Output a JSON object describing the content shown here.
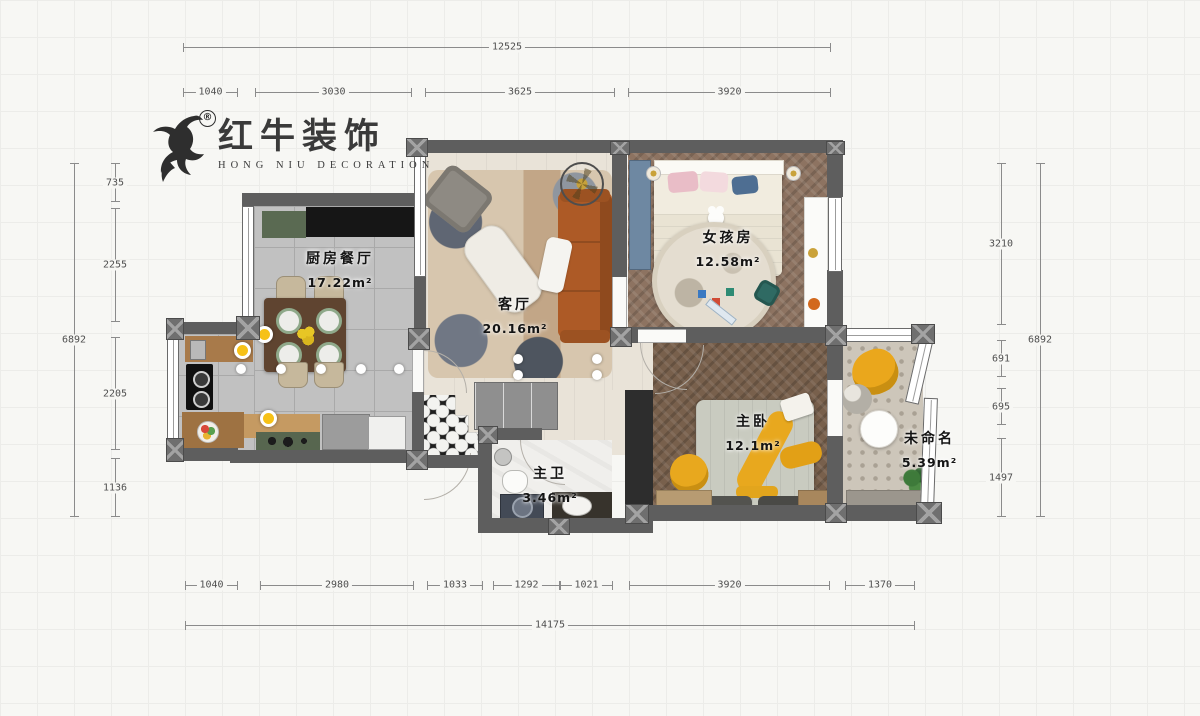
{
  "logo": {
    "brand": "红牛装饰",
    "subtitle": "HONG NIU DECORATION",
    "registered": "®"
  },
  "rooms": {
    "kitchen_dining": {
      "name": "厨房餐厅",
      "area": "17.22m²"
    },
    "living": {
      "name": "客厅",
      "area": "20.16m²"
    },
    "girls_room": {
      "name": "女孩房",
      "area": "12.58m²"
    },
    "master_bedroom": {
      "name": "主卧",
      "area": "12.1m²"
    },
    "master_bath": {
      "name": "主卫",
      "area": "3.46m²"
    },
    "unnamed": {
      "name": "未命名",
      "area": "5.39m²"
    }
  },
  "dimensions": {
    "top": {
      "overall": "12525",
      "segments": [
        "1040",
        "3030",
        "3625",
        "3920"
      ]
    },
    "bottom": {
      "overall": "14175",
      "segments": [
        "1040",
        "2980",
        "1033",
        "1292",
        "1021",
        "3920",
        "1370"
      ]
    },
    "left": {
      "overall": "6892",
      "segments": [
        "735",
        "2255",
        "2205",
        "1136"
      ]
    },
    "right": {
      "overall": "6892",
      "segments": [
        "3210",
        "691",
        "695",
        "1497"
      ]
    }
  },
  "colors": {
    "wall": "#5e5e5e",
    "accent_yellow": "#e8a71e",
    "sofa_orange": "#ad5a26",
    "dim_text": "#4f4f4f"
  }
}
